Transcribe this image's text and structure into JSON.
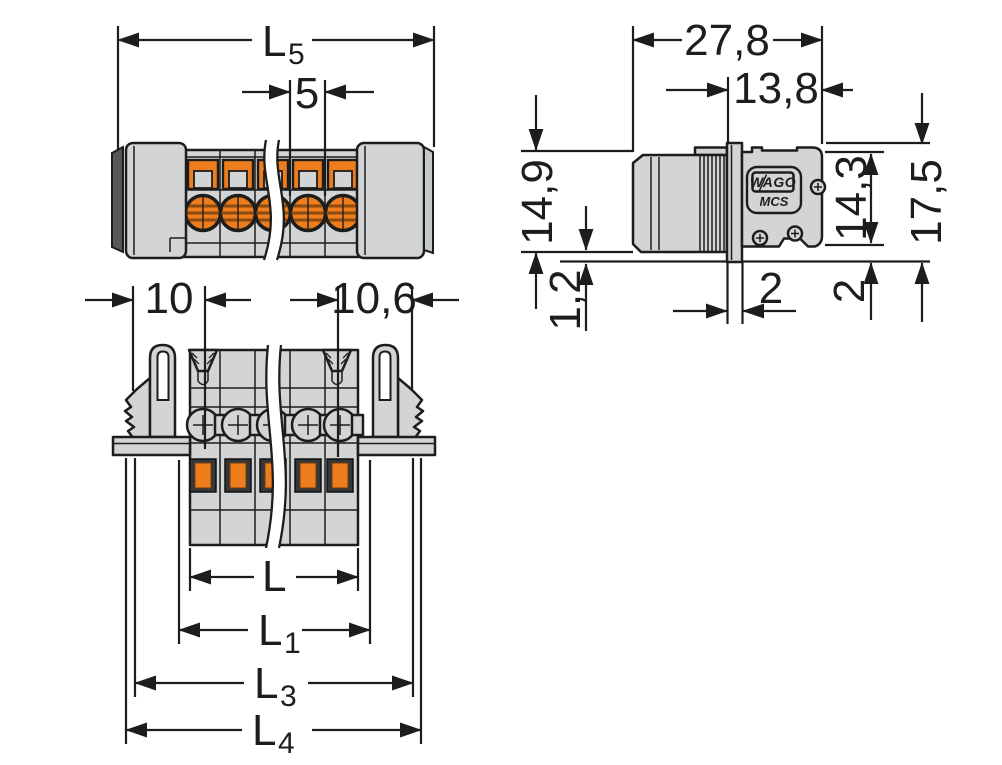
{
  "drawing_title": "connector-dimensional-drawing",
  "colors": {
    "line": "#1d1d1b",
    "body": "#d2d4d5",
    "orange": "#ee7d1e",
    "orange_dark": "#8a4a10",
    "dark": "#54585a",
    "strip_light": "#c6c9cb"
  },
  "front_view": {
    "dim_l5": {
      "base": "L",
      "sub": "5"
    },
    "dim_pitch": "5"
  },
  "side_view": {
    "dim_width": "27,8",
    "dim_depth": "13,8",
    "dim_height_left": "14,9",
    "dim_pin": "1,2",
    "dim_back_height": "14,3",
    "dim_total_height": "17,5",
    "dim_flange_thickness": "2",
    "dim_offset": "2",
    "logo": "WAGO",
    "series": "MCS"
  },
  "bottom_view": {
    "dim_left_flange": "10",
    "dim_right_flange": "10,6",
    "dim_l": {
      "base": "L",
      "sub": ""
    },
    "dim_l1": {
      "base": "L",
      "sub": "1"
    },
    "dim_l3": {
      "base": "L",
      "sub": "3"
    },
    "dim_l4": {
      "base": "L",
      "sub": "4"
    }
  }
}
